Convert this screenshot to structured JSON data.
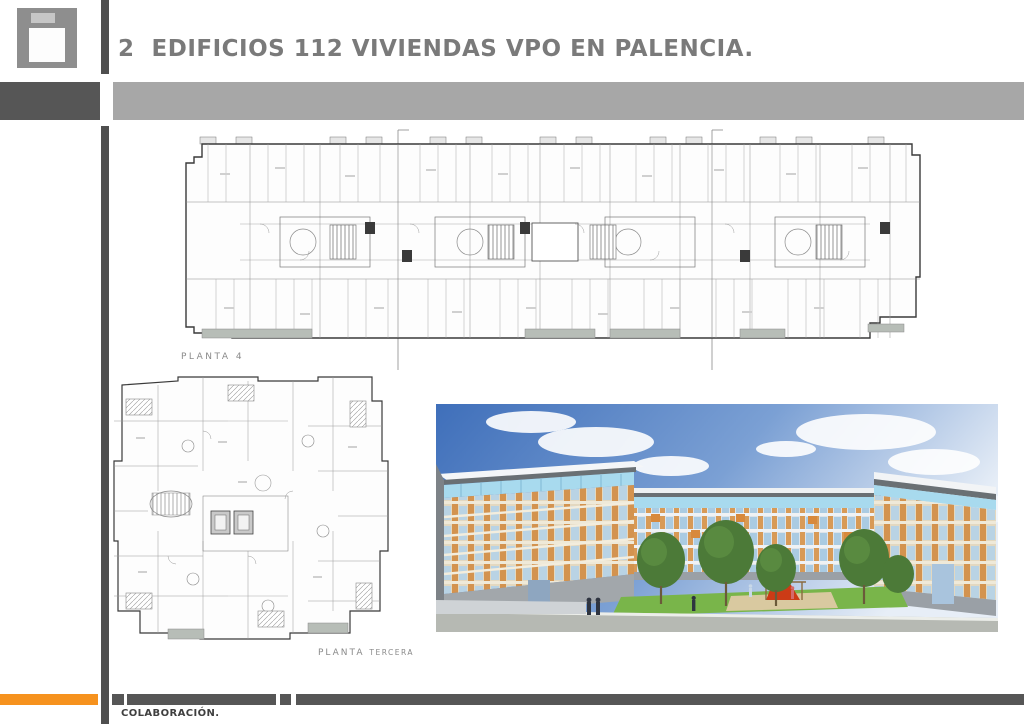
{
  "header": {
    "title": "2  EDIFICIOS 112 VIVIENDAS VPO EN PALENCIA."
  },
  "plans": {
    "planta4_label": "PLANTA 4",
    "planta_tercera_label_main": "PLANTA",
    "planta_tercera_label_sub": "TERCERA"
  },
  "footer": {
    "collaboration_label": "COLABORACIÓN."
  },
  "colors": {
    "accent_orange": "#F6921E",
    "dark_gray_bar": "#565656",
    "title_band_gray": "#A7A7A7",
    "title_text_gray": "#7A7A7A",
    "logo_gray": "#8E8E8E",
    "render_sky_blue": "#4272BD",
    "render_facade_orange": "#D3934F",
    "render_glass_blue": "#AADCEE",
    "render_lawn_green": "#79B54A",
    "render_slide_red": "#CC3B16"
  }
}
